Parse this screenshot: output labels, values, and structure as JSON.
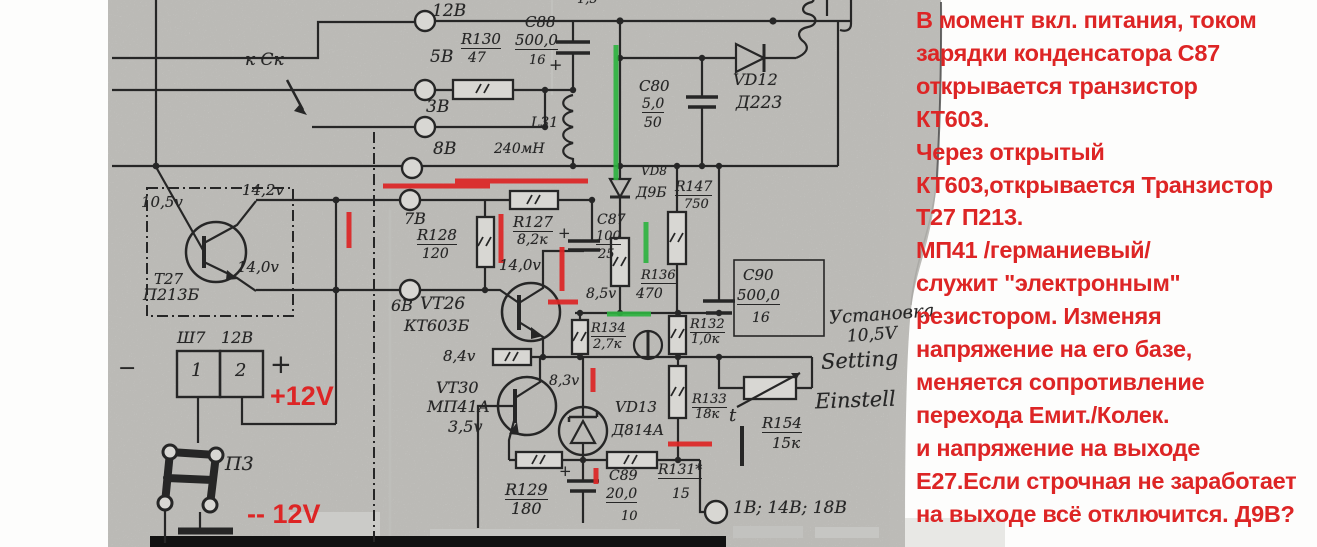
{
  "colors": {
    "annotation_red": "#dd2525",
    "annotation_green": "#2fb341",
    "ink": "#262626",
    "paper": "#d8d7d3"
  },
  "panel": {
    "lines": [
      "В момент вкл. питания, током",
      "зарядки конденсатора С87",
      "открывается транзистор",
      "КТ603.",
      "Через открытый",
      "КТ603,открывается Транзистор",
      "Т27 П213.",
      "МП41 /германиевый/",
      "служит \"электронным\"",
      "резистором. Изменяя",
      "напряжение на его базе,",
      "меняется сопротивление",
      "перехода Емит./Колек.",
      "и напряжение на выходе",
      "Е27.Если строчная не заработает",
      "на выходе всё отключится. Д9В?"
    ]
  },
  "schematic": {
    "labels": [
      {
        "n": "pin-12v",
        "t": "12В",
        "x": 432,
        "y": 3,
        "s": 17
      },
      {
        "n": "pin-5v",
        "t": "5В",
        "x": 430,
        "y": 49,
        "s": 17
      },
      {
        "n": "pin-3v",
        "t": "3В",
        "x": 426,
        "y": 99,
        "s": 17
      },
      {
        "n": "pin-8v",
        "t": "8В",
        "x": 433,
        "y": 141,
        "s": 17
      },
      {
        "n": "pin-7v",
        "t": "7В",
        "x": 404,
        "y": 211,
        "s": 16
      },
      {
        "n": "pin-6v",
        "t": "6В",
        "x": 391,
        "y": 298,
        "s": 16
      },
      {
        "n": "to-sk",
        "t": "к Ск",
        "x": 245,
        "y": 52,
        "s": 17
      },
      {
        "n": "top-partial",
        "t": "1,5",
        "x": 577,
        "y": -7,
        "s": 13
      },
      {
        "n": "r130-ref",
        "t": "R130",
        "x": 461,
        "y": 32,
        "s": 15,
        "u": 1
      },
      {
        "n": "r130-val",
        "t": "47",
        "x": 468,
        "y": 51,
        "s": 14
      },
      {
        "n": "c88-ref",
        "t": "С88",
        "x": 525,
        "y": 15,
        "s": 15
      },
      {
        "n": "c88-val",
        "t": "500,0",
        "x": 515,
        "y": 33,
        "s": 15,
        "u": 1
      },
      {
        "n": "c88-volt",
        "t": "16",
        "x": 529,
        "y": 54,
        "s": 13
      },
      {
        "n": "c88-plus",
        "t": "+",
        "x": 549,
        "y": 57,
        "s": 16
      },
      {
        "n": "l31-ref",
        "t": "L31",
        "x": 531,
        "y": 116,
        "s": 14
      },
      {
        "n": "l31-val",
        "t": "240мН",
        "x": 494,
        "y": 142,
        "s": 14
      },
      {
        "n": "c80-ref",
        "t": "С80",
        "x": 639,
        "y": 79,
        "s": 15
      },
      {
        "n": "c80-val",
        "t": "5,0",
        "x": 642,
        "y": 97,
        "s": 14,
        "u": 1
      },
      {
        "n": "c80-volt",
        "t": "50",
        "x": 644,
        "y": 116,
        "s": 14
      },
      {
        "n": "vd12-ref",
        "t": "VD12",
        "x": 733,
        "y": 72,
        "s": 16
      },
      {
        "n": "vd12-type",
        "t": "Д223",
        "x": 736,
        "y": 95,
        "s": 17
      },
      {
        "n": "vd8-ref",
        "t": "VD8",
        "x": 641,
        "y": 165,
        "s": 12
      },
      {
        "n": "vd8-type",
        "t": "Д9Б",
        "x": 636,
        "y": 186,
        "s": 14
      },
      {
        "n": "r147-ref",
        "t": "R147",
        "x": 675,
        "y": 180,
        "s": 14,
        "u": 1
      },
      {
        "n": "r147-val",
        "t": "750",
        "x": 684,
        "y": 198,
        "s": 13
      },
      {
        "n": "r127-ref",
        "t": "R127",
        "x": 513,
        "y": 215,
        "s": 15,
        "u": 1
      },
      {
        "n": "r127-val",
        "t": "8,2к",
        "x": 517,
        "y": 233,
        "s": 14
      },
      {
        "n": "c87-ref",
        "t": "С87",
        "x": 597,
        "y": 213,
        "s": 14
      },
      {
        "n": "c87-val",
        "t": "100",
        "x": 596,
        "y": 230,
        "s": 13,
        "u": 1
      },
      {
        "n": "c87-volt",
        "t": "25",
        "x": 598,
        "y": 248,
        "s": 13
      },
      {
        "n": "c87-plus",
        "t": "+",
        "x": 558,
        "y": 226,
        "s": 15
      },
      {
        "n": "r128-ref",
        "t": "R128",
        "x": 417,
        "y": 228,
        "s": 15,
        "u": 1
      },
      {
        "n": "r128-val",
        "t": "120",
        "x": 422,
        "y": 247,
        "s": 14
      },
      {
        "n": "t27-v1",
        "t": "10,5v",
        "x": 141,
        "y": 195,
        "s": 15
      },
      {
        "n": "t27-v2",
        "t": "14,2v",
        "x": 242,
        "y": 183,
        "s": 15
      },
      {
        "n": "t27-v3",
        "t": "14,0v",
        "x": 237,
        "y": 260,
        "s": 15
      },
      {
        "n": "t27-ref",
        "t": "Т27",
        "x": 154,
        "y": 272,
        "s": 15
      },
      {
        "n": "t27-type",
        "t": "П213Б",
        "x": 143,
        "y": 287,
        "s": 16
      },
      {
        "n": "vt26-volt",
        "t": "14,0v",
        "x": 499,
        "y": 258,
        "s": 15
      },
      {
        "n": "vt26-ref",
        "t": "VT26",
        "x": 420,
        "y": 296,
        "s": 17
      },
      {
        "n": "vt26-type",
        "t": "КТ603Б",
        "x": 404,
        "y": 318,
        "s": 16
      },
      {
        "n": "node-volt",
        "t": "8,5v",
        "x": 586,
        "y": 287,
        "s": 14
      },
      {
        "n": "r136-ref",
        "t": "R136",
        "x": 641,
        "y": 269,
        "s": 13,
        "u": 1
      },
      {
        "n": "r136-val",
        "t": "470",
        "x": 636,
        "y": 287,
        "s": 14
      },
      {
        "n": "r134-ref",
        "t": "R134",
        "x": 591,
        "y": 322,
        "s": 13,
        "u": 1
      },
      {
        "n": "r134-val",
        "t": "2,7к",
        "x": 593,
        "y": 338,
        "s": 13
      },
      {
        "n": "r132-ref",
        "t": "R132",
        "x": 690,
        "y": 318,
        "s": 13,
        "u": 1
      },
      {
        "n": "r132-val",
        "t": "1,0к",
        "x": 691,
        "y": 333,
        "s": 13
      },
      {
        "n": "r133-ref",
        "t": "R133",
        "x": 692,
        "y": 393,
        "s": 13,
        "u": 1
      },
      {
        "n": "r133-val",
        "t": "18к",
        "x": 695,
        "y": 408,
        "s": 13
      },
      {
        "n": "vt26-emitter-volt",
        "t": "8,4v",
        "x": 443,
        "y": 349,
        "s": 15
      },
      {
        "n": "vt30-collector-volt",
        "t": "8,3v",
        "x": 549,
        "y": 374,
        "s": 14
      },
      {
        "n": "vt30-ref",
        "t": "VT30",
        "x": 436,
        "y": 380,
        "s": 16
      },
      {
        "n": "vt30-type",
        "t": "МП41А",
        "x": 427,
        "y": 399,
        "s": 16
      },
      {
        "n": "vt30-base-volt",
        "t": "3,5v",
        "x": 448,
        "y": 419,
        "s": 16
      },
      {
        "n": "vd13-ref",
        "t": "VD13",
        "x": 615,
        "y": 400,
        "s": 15
      },
      {
        "n": "vd13-type",
        "t": "Д814А",
        "x": 612,
        "y": 423,
        "s": 15
      },
      {
        "n": "r154-ref",
        "t": "R154",
        "x": 762,
        "y": 416,
        "s": 15,
        "u": 1
      },
      {
        "n": "r154-val",
        "t": "15к",
        "x": 772,
        "y": 436,
        "s": 15
      },
      {
        "n": "thermo",
        "t": "t",
        "x": 729,
        "y": 407,
        "s": 18
      },
      {
        "n": "c90-ref",
        "t": "С90",
        "x": 743,
        "y": 268,
        "s": 15
      },
      {
        "n": "c90-val",
        "t": "500,0",
        "x": 737,
        "y": 288,
        "s": 15,
        "u": 1
      },
      {
        "n": "c90-volt",
        "t": "16",
        "x": 752,
        "y": 311,
        "s": 14
      },
      {
        "n": "r129-ref",
        "t": "R129",
        "x": 505,
        "y": 482,
        "s": 16,
        "u": 1
      },
      {
        "n": "r129-val",
        "t": "180",
        "x": 511,
        "y": 501,
        "s": 16
      },
      {
        "n": "c89-ref",
        "t": "С89",
        "x": 609,
        "y": 469,
        "s": 14
      },
      {
        "n": "c89-val",
        "t": "20,0",
        "x": 606,
        "y": 487,
        "s": 14,
        "u": 1
      },
      {
        "n": "c89-volt",
        "t": "10",
        "x": 621,
        "y": 510,
        "s": 13
      },
      {
        "n": "c89-plus",
        "t": "+",
        "x": 559,
        "y": 464,
        "s": 15
      },
      {
        "n": "r131-ref",
        "t": "R131*",
        "x": 658,
        "y": 463,
        "s": 14,
        "u": 1
      },
      {
        "n": "r131-val",
        "t": "15",
        "x": 672,
        "y": 487,
        "s": 14
      },
      {
        "n": "out-voltages",
        "t": "1В; 14В; 18В",
        "x": 733,
        "y": 500,
        "s": 17
      },
      {
        "n": "sh7-ref",
        "t": "Ш7",
        "x": 177,
        "y": 330,
        "s": 16
      },
      {
        "n": "sh7-volt",
        "t": "12В",
        "x": 221,
        "y": 330,
        "s": 16
      },
      {
        "n": "sh7-pin1",
        "t": "1",
        "x": 191,
        "y": 362,
        "s": 18
      },
      {
        "n": "sh7-pin2",
        "t": "2",
        "x": 235,
        "y": 362,
        "s": 18
      },
      {
        "n": "sh7-minus",
        "t": "−",
        "x": 118,
        "y": 358,
        "s": 22
      },
      {
        "n": "sh7-plus",
        "t": "+",
        "x": 270,
        "y": 352,
        "s": 26
      },
      {
        "n": "p3-ref",
        "t": "П3",
        "x": 225,
        "y": 455,
        "s": 19
      },
      {
        "n": "setting-ru",
        "t": "Установка",
        "x": 829,
        "y": 306,
        "s": 18,
        "r": -4
      },
      {
        "n": "setting-val",
        "t": "10,5V",
        "x": 847,
        "y": 327,
        "s": 17,
        "r": -4
      },
      {
        "n": "setting-en",
        "t": "Setting",
        "x": 821,
        "y": 350,
        "s": 21,
        "r": -3
      },
      {
        "n": "setting-de",
        "t": "Einstell",
        "x": 815,
        "y": 390,
        "s": 21,
        "r": -2
      },
      {
        "n": "plus-12v",
        "t": "+12V",
        "x": 270,
        "y": 383,
        "s": 27,
        "cls": "red"
      },
      {
        "n": "minus-12v",
        "t": "-- 12V",
        "x": 247,
        "y": 501,
        "s": 27,
        "cls": "red"
      }
    ]
  }
}
